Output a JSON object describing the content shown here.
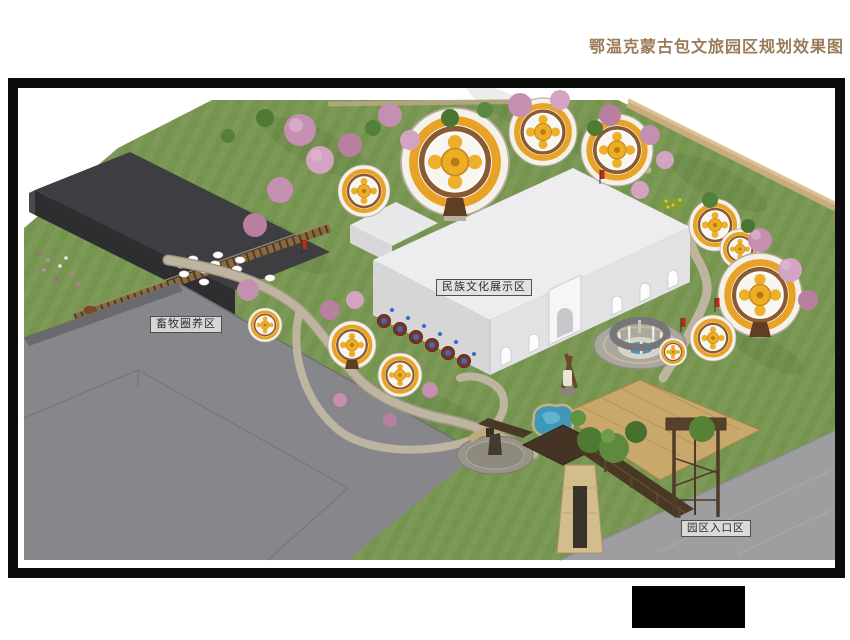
{
  "title": {
    "text": "鄂温克蒙古包文旅园区规划效果图",
    "color": "#9a7a58"
  },
  "zones": {
    "livestock": "畜牧圈养区",
    "culture": "民族文化展示区",
    "entrance": "园区入口区"
  },
  "palette": {
    "frame_border": "#0c0c0c",
    "grass": "#75944e",
    "dark_roof": "#3e3e42",
    "gray_roof": "#87878b",
    "pavement": "#9e9ea0",
    "white_building_roof": "#ededef",
    "white_building_wall": "#e2e2e4",
    "yurt_gold": "#eeae24",
    "yurt_band_brown": "#8a5a30",
    "blossom_pink": "#c48fb0",
    "boundary_wall_tan": "#c9ab7d",
    "wood_brown": "#4a3826",
    "water_blue": "#3f98b8",
    "logo_block": "#000000"
  }
}
